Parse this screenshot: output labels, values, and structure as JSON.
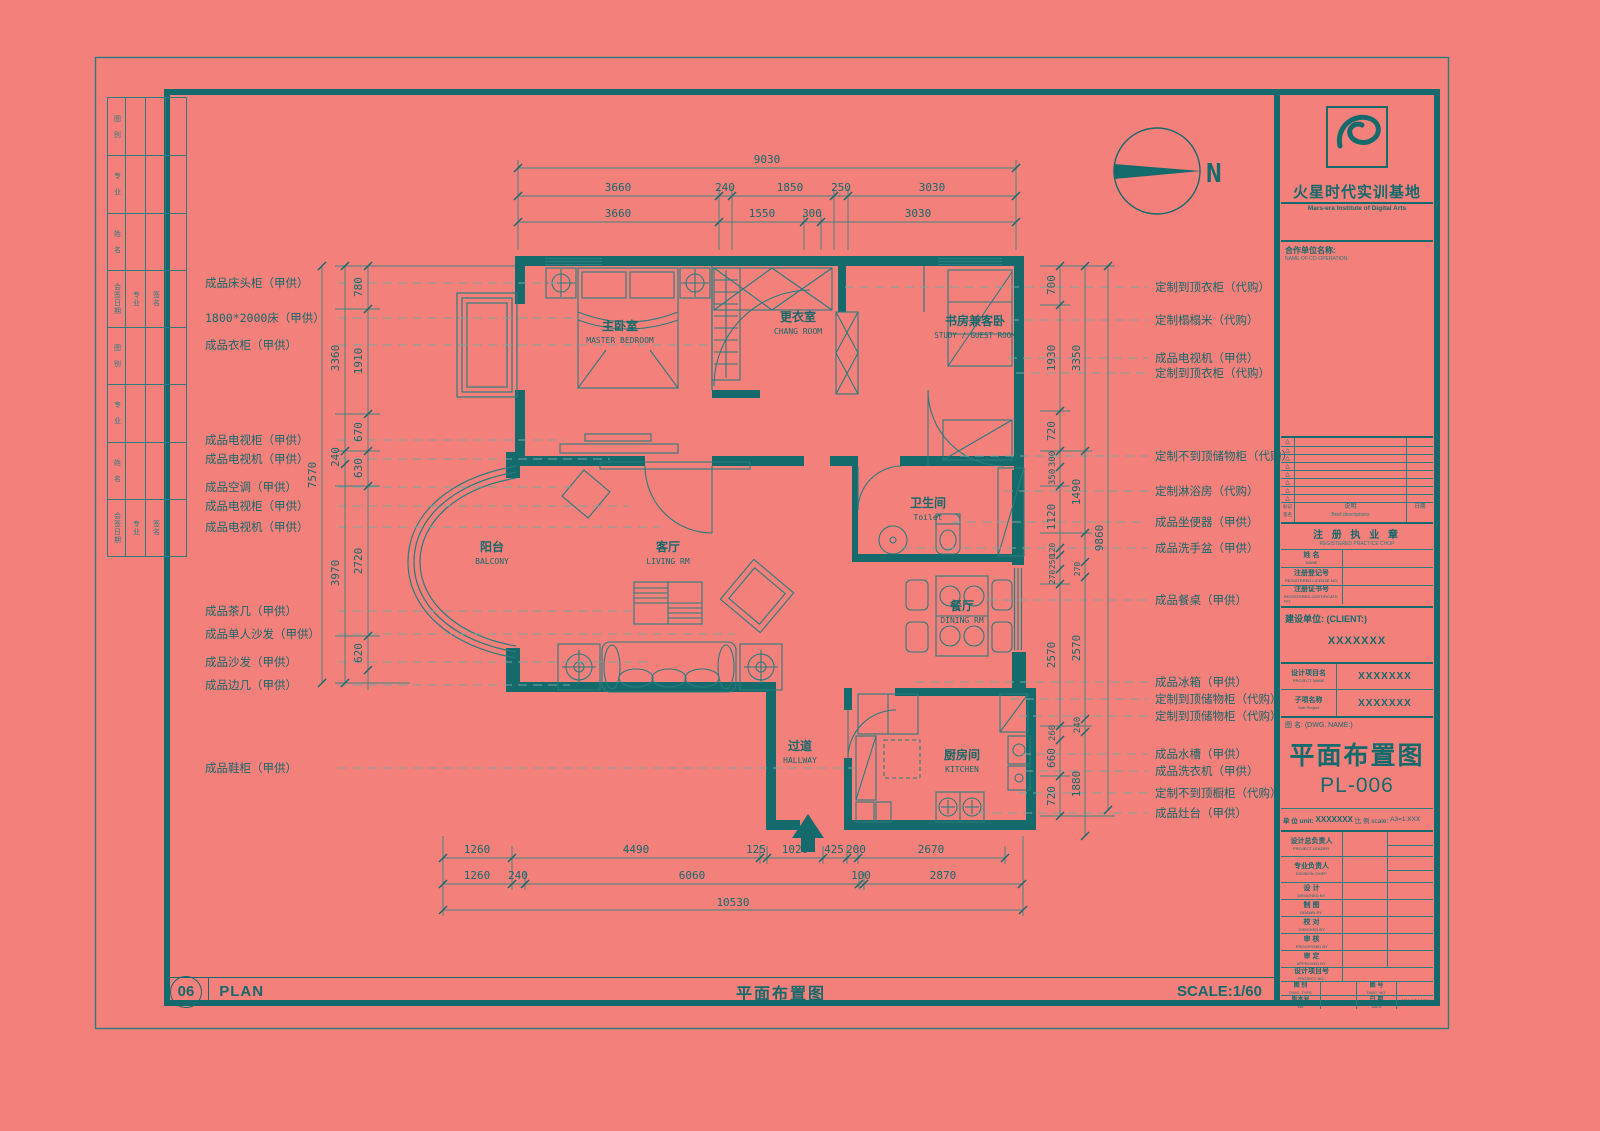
{
  "colors": {
    "bg": "#f4807b",
    "ink": "#156a6c",
    "line": "#2a7c7e",
    "dim": "#3f837f",
    "dash": "#7fa39e"
  },
  "icons": {
    "tri": "△"
  },
  "north": {
    "label": "N"
  },
  "logo": {
    "brand": "火星时代实训基地",
    "brand_en": "Mars-era Institute of Digital Arts"
  },
  "sign": {
    "cells": [
      "图 别",
      "专 业",
      "姓 名",
      "会签日期",
      "专业",
      "签名",
      "图 别",
      "专 业",
      "姓 名",
      "会签日期",
      "专业",
      "签名"
    ]
  },
  "rooms": {
    "master": {
      "cn": "主卧室",
      "en": "MASTER BEDROOM"
    },
    "chang": {
      "cn": "更衣室",
      "en": "CHANG ROOM"
    },
    "study": {
      "cn": "书房兼客卧",
      "en": "STUDY / GUEST ROOM"
    },
    "toilet": {
      "cn": "卫生间",
      "en": "Toilet"
    },
    "balcony": {
      "cn": "阳台",
      "en": "BALCONY"
    },
    "living": {
      "cn": "客厅",
      "en": "LIVING RM"
    },
    "dining": {
      "cn": "餐厅",
      "en": "DINING RM"
    },
    "hallway": {
      "cn": "过道",
      "en": "HALLWAY"
    },
    "kitchen": {
      "cn": "厨房间",
      "en": "KITCHEN"
    }
  },
  "left_labels": [
    "成品床头柜（甲供）",
    "1800*2000床（甲供）",
    "成品衣柜（甲供）",
    "成品电视柜（甲供）",
    "成品电视机（甲供）",
    "成品空调（甲供）",
    "成品电视柜（甲供）",
    "成品电视机（甲供）",
    "成品茶几（甲供）",
    "成品单人沙发（甲供）",
    "成品沙发（甲供）",
    "成品边几（甲供）",
    "成品鞋柜（甲供）"
  ],
  "right_labels": [
    "定制到顶衣柜（代购）",
    "定制榻榻米（代购）",
    "成品电视机（甲供）",
    "定制到顶衣柜（代购）",
    "定制不到顶储物柜（代购）",
    "定制淋浴房（代购）",
    "成品坐便器（甲供）",
    "成品洗手盆（甲供）",
    "成品餐桌（甲供）",
    "成品冰箱（甲供）",
    "定制到顶储物柜（代购）",
    "定制到顶储物柜（代购）",
    "成品水槽（甲供）",
    "成品洗衣机（甲供）",
    "定制不到顶橱柜（代购）",
    "成品灶台（甲供）"
  ],
  "dims": {
    "top1": "9030",
    "top2": [
      "3660",
      "240",
      "1850",
      "250",
      "3030"
    ],
    "top3": [
      "3660",
      "1550",
      "300",
      "3030"
    ],
    "bottom1": [
      "1260",
      "4490",
      "125",
      "1020",
      "425",
      "200",
      "2670"
    ],
    "bottom2": [
      "1260",
      "240",
      "6060",
      "100",
      "2870"
    ],
    "bottom3": "10530",
    "left_inner": [
      "780",
      "1910",
      "670",
      "630",
      "2720",
      "620"
    ],
    "left_mid": [
      "3360",
      "240",
      "3970"
    ],
    "left_outer": "7570",
    "right_inner": [
      "700",
      "1930",
      "720",
      "300",
      "350",
      "1120",
      "120",
      "250",
      "270",
      "2570",
      "260",
      "660",
      "720"
    ],
    "right_mid": [
      "3350",
      "1490",
      "270",
      "2570",
      "240",
      "1880"
    ],
    "right_outer": "9860"
  },
  "titleblock": {
    "coop_cn": "合作单位名称:",
    "coop_en": "NAME OF CO-OPERATION:",
    "rev_left": "标记 签名",
    "rev_mid_cn": "说明",
    "rev_mid_en": "Brief descriptions",
    "rev_right": "日期",
    "chop_cn": "注 册 执 业 章",
    "chop_en": "REGISTERED PRACTICE CHOP",
    "name_cn": "姓  名",
    "name_en": "NAME",
    "license_cn": "注册登记号",
    "license_en": "REGISTERED LICENSE NO.",
    "cert_cn": "注册证书号",
    "cert_en": "REGISTERED CERTIFICATE NO.",
    "client_label": "建设单位: (CLIENT:)",
    "client_value": "XXXXXXX",
    "project_cn": "设计项目名",
    "project_en": "PROJECT NAME",
    "project_value": "XXXXXXX",
    "subproject_cn": "子项名称",
    "subproject_en": "Sub Project",
    "subproject_value": "XXXXXXX",
    "dwg_label": "图  名: (DWG. NAME:)",
    "dwg_title": "平面布置图",
    "dwg_code": "PL-006",
    "unit_cn": "单 位 unit:",
    "unit_value": "XXXXXXX",
    "scale_cn": "比 例 scale:",
    "scale_value": "A3=1:XXX",
    "rows": [
      {
        "cn": "设计总负责人",
        "en": "PROJECT LEADER"
      },
      {
        "cn": "专业负责人",
        "en": "DIVISION CHIEF"
      },
      {
        "cn": "设  计",
        "en": "DESIGNED BY"
      },
      {
        "cn": "制  图",
        "en": "DRAWN BY"
      },
      {
        "cn": "校  对",
        "en": "CHECKED BY"
      },
      {
        "cn": "审  核",
        "en": "PROCESSED BY"
      },
      {
        "cn": "审  定",
        "en": "APPROVED BY"
      },
      {
        "cn": "设计项目号",
        "en": "PROJECT NO."
      }
    ],
    "dwgtype_cn": "图 别",
    "dwgtype_en": "DWG. TYPE",
    "dwgno_cn": "图 号",
    "dwgno_en": "DWG. NO.",
    "ver_cn": "版本号",
    "ver_en": "Ver.",
    "date_cn": "日 期",
    "date_en": "DATE",
    "date_value": "XX XX XX"
  },
  "footer": {
    "index": "06",
    "plan": "PLAN",
    "title": "平面布置图",
    "scale": "SCALE:1/60"
  }
}
